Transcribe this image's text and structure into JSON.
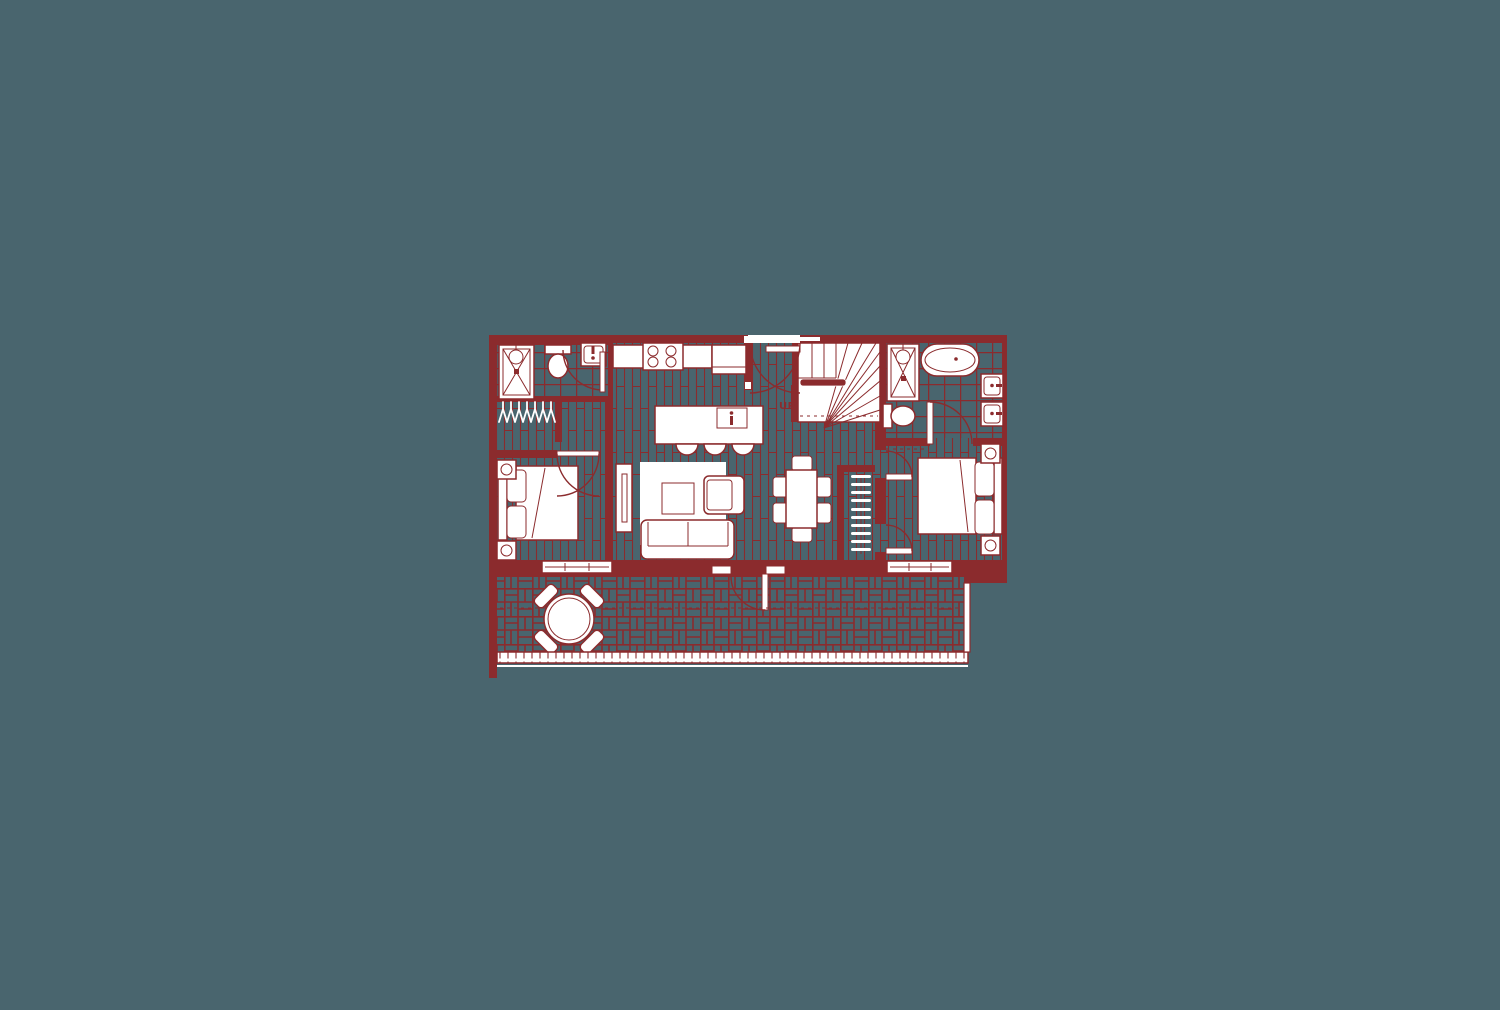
{
  "canvas": {
    "colors": {
      "teal": "#49656e",
      "maroon": "#8b2b2d",
      "white": "#ffffff"
    }
  },
  "floor_plan": {
    "type": "residential-unit-floor-plan",
    "stairs": {
      "up_label": "UP"
    },
    "rooms": [
      "bathroom-left",
      "closet-left",
      "bedroom-left",
      "kitchen",
      "living-area",
      "entry",
      "staircase",
      "dining-area",
      "closet-middle",
      "bathroom-right",
      "bedroom-right",
      "balcony"
    ],
    "fixtures": [
      "shower-left",
      "toilet-left",
      "sink-left",
      "cooktop-4-burner",
      "refrigerator",
      "island-sink",
      "shower-right",
      "freestanding-bathtub",
      "double-vanity",
      "toilet-right"
    ],
    "furniture": [
      "bed-left",
      "nightstands-left",
      "tv-console",
      "rug",
      "coffee-table",
      "armchair",
      "sofa",
      "kitchen-island",
      "bar-stools",
      "dining-table",
      "dining-chairs",
      "hangers-left",
      "hangers-middle",
      "bed-right",
      "nightstands-right",
      "outdoor-table",
      "outdoor-chairs"
    ]
  }
}
